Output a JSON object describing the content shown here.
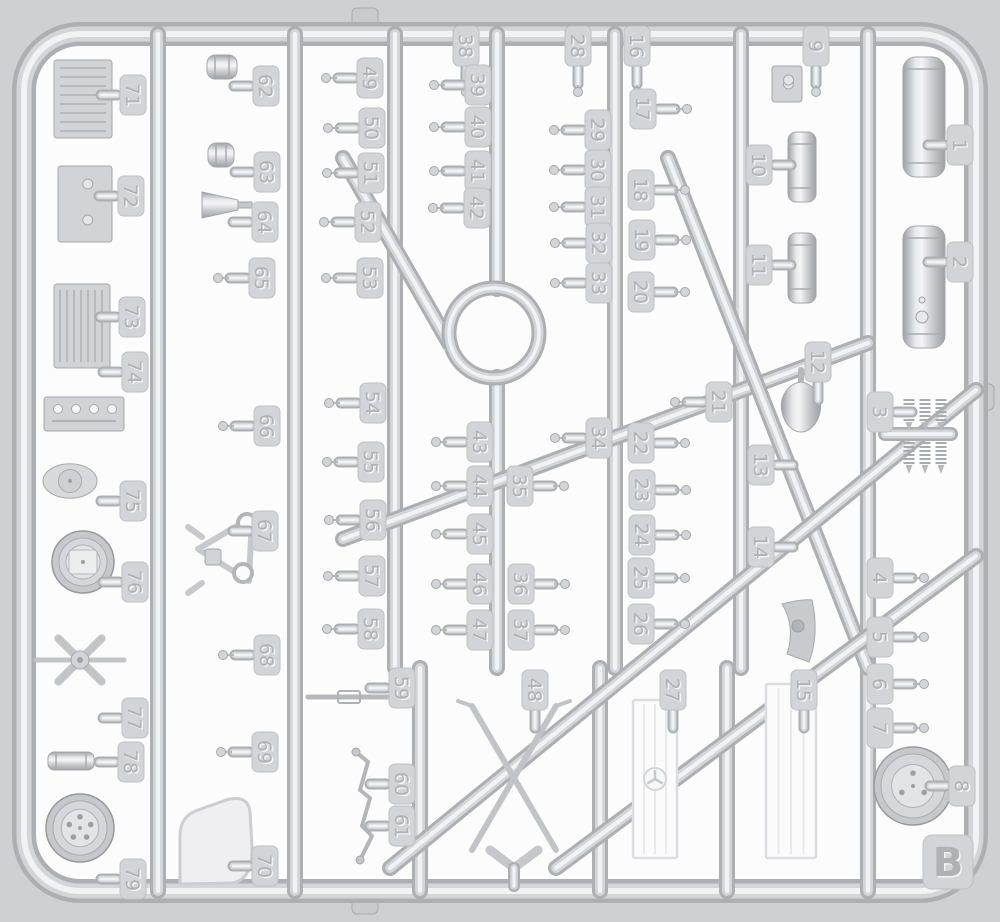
{
  "diagram": {
    "kind": "plastic-model-kit-sprue-map",
    "sprue_letter": "B",
    "numbered_parts_count": 79
  },
  "colors": {
    "page_background": "#cfd0d3",
    "cell_white": "#fcfcfd",
    "plastic_dark": "#aeafb3",
    "plastic_mid": "#d4d5d8",
    "plastic_light": "#f1f2f4",
    "part_fill": "#d2d3d6",
    "part_stroke": "#a5a6aa",
    "tag_fill": "#d3d4d7",
    "tag_border": "#bfc0c3",
    "number_emboss_dark": "#b0b1b5",
    "number_emboss_light": "#f4f4f6"
  },
  "letter_tag": {
    "label": "B",
    "x": 948,
    "y": 862
  },
  "tags": [
    {
      "label": "1",
      "x": 960,
      "y": 145,
      "dir": "left"
    },
    {
      "label": "2",
      "x": 960,
      "y": 262,
      "dir": "left"
    },
    {
      "label": "3",
      "x": 880,
      "y": 412,
      "dir": "right"
    },
    {
      "label": "4",
      "x": 880,
      "y": 578,
      "dir": "right"
    },
    {
      "label": "5",
      "x": 880,
      "y": 637,
      "dir": "right"
    },
    {
      "label": "6",
      "x": 880,
      "y": 684,
      "dir": "right"
    },
    {
      "label": "7",
      "x": 880,
      "y": 728,
      "dir": "right"
    },
    {
      "label": "8",
      "x": 962,
      "y": 786,
      "dir": "left"
    },
    {
      "label": "9",
      "x": 816,
      "y": 46,
      "dir": "down"
    },
    {
      "label": "10",
      "x": 759,
      "y": 165,
      "dir": "right"
    },
    {
      "label": "11",
      "x": 759,
      "y": 265,
      "dir": "right"
    },
    {
      "label": "12",
      "x": 818,
      "y": 362,
      "dir": "down"
    },
    {
      "label": "13",
      "x": 761,
      "y": 465,
      "dir": "right"
    },
    {
      "label": "14",
      "x": 761,
      "y": 547,
      "dir": "right"
    },
    {
      "label": "15",
      "x": 804,
      "y": 690,
      "dir": "down"
    },
    {
      "label": "16",
      "x": 637,
      "y": 46,
      "dir": "down"
    },
    {
      "label": "17",
      "x": 643,
      "y": 109,
      "dir": "right"
    },
    {
      "label": "18",
      "x": 641,
      "y": 190,
      "dir": "right"
    },
    {
      "label": "19",
      "x": 642,
      "y": 240,
      "dir": "right"
    },
    {
      "label": "20",
      "x": 641,
      "y": 292,
      "dir": "right"
    },
    {
      "label": "21",
      "x": 719,
      "y": 402,
      "dir": "left"
    },
    {
      "label": "22",
      "x": 641,
      "y": 443,
      "dir": "right"
    },
    {
      "label": "23",
      "x": 642,
      "y": 490,
      "dir": "right"
    },
    {
      "label": "24",
      "x": 642,
      "y": 535,
      "dir": "right"
    },
    {
      "label": "25",
      "x": 641,
      "y": 578,
      "dir": "right"
    },
    {
      "label": "26",
      "x": 641,
      "y": 624,
      "dir": "right"
    },
    {
      "label": "27",
      "x": 673,
      "y": 690,
      "dir": "down"
    },
    {
      "label": "28",
      "x": 578,
      "y": 46,
      "dir": "down"
    },
    {
      "label": "29",
      "x": 598,
      "y": 130,
      "dir": "left"
    },
    {
      "label": "30",
      "x": 598,
      "y": 170,
      "dir": "left"
    },
    {
      "label": "31",
      "x": 598,
      "y": 207,
      "dir": "left"
    },
    {
      "label": "32",
      "x": 599,
      "y": 243,
      "dir": "left"
    },
    {
      "label": "33",
      "x": 599,
      "y": 283,
      "dir": "left"
    },
    {
      "label": "34",
      "x": 599,
      "y": 438,
      "dir": "left"
    },
    {
      "label": "35",
      "x": 520,
      "y": 486,
      "dir": "right"
    },
    {
      "label": "36",
      "x": 521,
      "y": 584,
      "dir": "right"
    },
    {
      "label": "37",
      "x": 521,
      "y": 630,
      "dir": "right"
    },
    {
      "label": "38",
      "x": 466,
      "y": 46,
      "dir": "down"
    },
    {
      "label": "39",
      "x": 478,
      "y": 85,
      "dir": "left"
    },
    {
      "label": "40",
      "x": 478,
      "y": 127,
      "dir": "left"
    },
    {
      "label": "41",
      "x": 478,
      "y": 171,
      "dir": "left"
    },
    {
      "label": "42",
      "x": 477,
      "y": 208,
      "dir": "left"
    },
    {
      "label": "43",
      "x": 480,
      "y": 442,
      "dir": "left"
    },
    {
      "label": "44",
      "x": 480,
      "y": 486,
      "dir": "left"
    },
    {
      "label": "45",
      "x": 480,
      "y": 534,
      "dir": "left"
    },
    {
      "label": "46",
      "x": 480,
      "y": 584,
      "dir": "left"
    },
    {
      "label": "47",
      "x": 480,
      "y": 630,
      "dir": "left"
    },
    {
      "label": "48",
      "x": 535,
      "y": 690,
      "dir": "down"
    },
    {
      "label": "49",
      "x": 370,
      "y": 78,
      "dir": "left"
    },
    {
      "label": "50",
      "x": 372,
      "y": 128,
      "dir": "left"
    },
    {
      "label": "51",
      "x": 371,
      "y": 173,
      "dir": "left"
    },
    {
      "label": "52",
      "x": 368,
      "y": 222,
      "dir": "left"
    },
    {
      "label": "53",
      "x": 370,
      "y": 278,
      "dir": "left"
    },
    {
      "label": "54",
      "x": 373,
      "y": 403,
      "dir": "left"
    },
    {
      "label": "55",
      "x": 371,
      "y": 462,
      "dir": "left"
    },
    {
      "label": "56",
      "x": 373,
      "y": 520,
      "dir": "left"
    },
    {
      "label": "57",
      "x": 372,
      "y": 576,
      "dir": "left"
    },
    {
      "label": "58",
      "x": 371,
      "y": 629,
      "dir": "left"
    },
    {
      "label": "59",
      "x": 402,
      "y": 688,
      "dir": "left"
    },
    {
      "label": "60",
      "x": 402,
      "y": 784,
      "dir": "left"
    },
    {
      "label": "61",
      "x": 402,
      "y": 826,
      "dir": "left"
    },
    {
      "label": "62",
      "x": 266,
      "y": 86,
      "dir": "left"
    },
    {
      "label": "63",
      "x": 267,
      "y": 172,
      "dir": "left"
    },
    {
      "label": "64",
      "x": 265,
      "y": 222,
      "dir": "left"
    },
    {
      "label": "65",
      "x": 262,
      "y": 278,
      "dir": "left"
    },
    {
      "label": "66",
      "x": 267,
      "y": 426,
      "dir": "left"
    },
    {
      "label": "67",
      "x": 265,
      "y": 531,
      "dir": "left"
    },
    {
      "label": "68",
      "x": 267,
      "y": 655,
      "dir": "left"
    },
    {
      "label": "69",
      "x": 265,
      "y": 752,
      "dir": "left"
    },
    {
      "label": "70",
      "x": 265,
      "y": 866,
      "dir": "left"
    },
    {
      "label": "71",
      "x": 133,
      "y": 95,
      "dir": "left"
    },
    {
      "label": "72",
      "x": 131,
      "y": 196,
      "dir": "left"
    },
    {
      "label": "73",
      "x": 132,
      "y": 317,
      "dir": "left"
    },
    {
      "label": "74",
      "x": 135,
      "y": 372,
      "dir": "left"
    },
    {
      "label": "75",
      "x": 133,
      "y": 501,
      "dir": "left"
    },
    {
      "label": "76",
      "x": 135,
      "y": 582,
      "dir": "left"
    },
    {
      "label": "77",
      "x": 135,
      "y": 718,
      "dir": "left"
    },
    {
      "label": "78",
      "x": 131,
      "y": 762,
      "dir": "left"
    },
    {
      "label": "79",
      "x": 133,
      "y": 879,
      "dir": "left"
    }
  ],
  "parts": [
    {
      "name": "fuel-tank-1",
      "type": "cylinder-v",
      "x": 903,
      "y": 57,
      "w": 42,
      "h": 120
    },
    {
      "name": "fuel-tank-2",
      "type": "cylinder-v",
      "x": 903,
      "y": 226,
      "w": 42,
      "h": 122,
      "dots": [
        [
          922,
          300,
          3
        ],
        [
          922,
          317,
          6
        ]
      ]
    },
    {
      "name": "engine-block-71",
      "type": "ribbed-box",
      "x": 54,
      "y": 60,
      "w": 58,
      "h": 78,
      "ribs": "h"
    },
    {
      "name": "gearbox-72",
      "type": "ribbed-box",
      "x": 58,
      "y": 166,
      "w": 54,
      "h": 76,
      "ribs": "none"
    },
    {
      "name": "oil-pan-73",
      "type": "ribbed-box",
      "x": 54,
      "y": 284,
      "w": 56,
      "h": 84,
      "ribs": "v"
    },
    {
      "name": "cylinder-head-74",
      "type": "ribbed-box",
      "x": 44,
      "y": 397,
      "w": 80,
      "h": 34,
      "ribs": "holes"
    },
    {
      "name": "round-cover-75",
      "type": "round-cover",
      "x": 70,
      "y": 481,
      "r": 21
    },
    {
      "name": "flywheel-76",
      "type": "wheel",
      "x": 83,
      "y": 562,
      "r": 31,
      "lugs": 0,
      "square": true
    },
    {
      "name": "fan-77",
      "type": "fan",
      "x": 80,
      "y": 660,
      "r": 30
    },
    {
      "name": "filter-78",
      "type": "cylinder-h",
      "x": 48,
      "y": 752,
      "w": 46,
      "h": 18
    },
    {
      "name": "road-wheel-79",
      "type": "wheel",
      "x": 80,
      "y": 828,
      "r": 34,
      "lugs": 5
    },
    {
      "name": "wheel-hub-8",
      "type": "wheel",
      "x": 913,
      "y": 786,
      "r": 39,
      "lugs": 3
    },
    {
      "name": "carburetor-9",
      "type": "ribbed-box",
      "x": 772,
      "y": 66,
      "w": 30,
      "h": 36,
      "ribs": "none"
    },
    {
      "name": "tank-10",
      "type": "cylinder-v",
      "x": 788,
      "y": 132,
      "w": 28,
      "h": 70
    },
    {
      "name": "tank-11",
      "type": "cylinder-v",
      "x": 788,
      "y": 233,
      "w": 28,
      "h": 70
    },
    {
      "name": "horn-12",
      "type": "teardrop",
      "x": 783,
      "y": 382,
      "w": 36,
      "h": 50
    },
    {
      "name": "mudflap-14",
      "type": "mudflap",
      "x": 782,
      "y": 600,
      "w": 34,
      "h": 62
    },
    {
      "name": "radiator-core-15",
      "type": "radiator",
      "x": 766,
      "y": 684,
      "w": 50,
      "h": 174,
      "star": false
    },
    {
      "name": "radiator-grille-27",
      "type": "radiator",
      "x": 633,
      "y": 700,
      "w": 44,
      "h": 158,
      "star": true
    },
    {
      "name": "cross-brace-48",
      "type": "x-brace",
      "x": 472,
      "y": 706,
      "w": 84,
      "h": 144
    },
    {
      "name": "coil-springs-3",
      "type": "coil-springs",
      "x": 893,
      "y": 400,
      "w": 72,
      "h": 68
    },
    {
      "name": "piston-62",
      "type": "cylinder-h",
      "x": 207,
      "y": 55,
      "w": 30,
      "h": 24
    },
    {
      "name": "piston-63",
      "type": "cylinder-h",
      "x": 208,
      "y": 143,
      "w": 26,
      "h": 24
    },
    {
      "name": "funnel-64",
      "type": "funnel",
      "x": 202,
      "y": 192,
      "w": 50,
      "h": 26
    },
    {
      "name": "belt-guide-67",
      "type": "triangle-belt",
      "x": 198,
      "y": 505,
      "w": 60,
      "h": 78
    },
    {
      "name": "hatch-70",
      "type": "d-hatch",
      "x": 176,
      "y": 800,
      "w": 78,
      "h": 84
    },
    {
      "name": "linkage-59",
      "type": "rod-h",
      "x": 308,
      "y": 697,
      "w": 88
    },
    {
      "name": "gear-linkage-60-61",
      "type": "rod-zigzag",
      "x": 356,
      "y": 752
    }
  ]
}
